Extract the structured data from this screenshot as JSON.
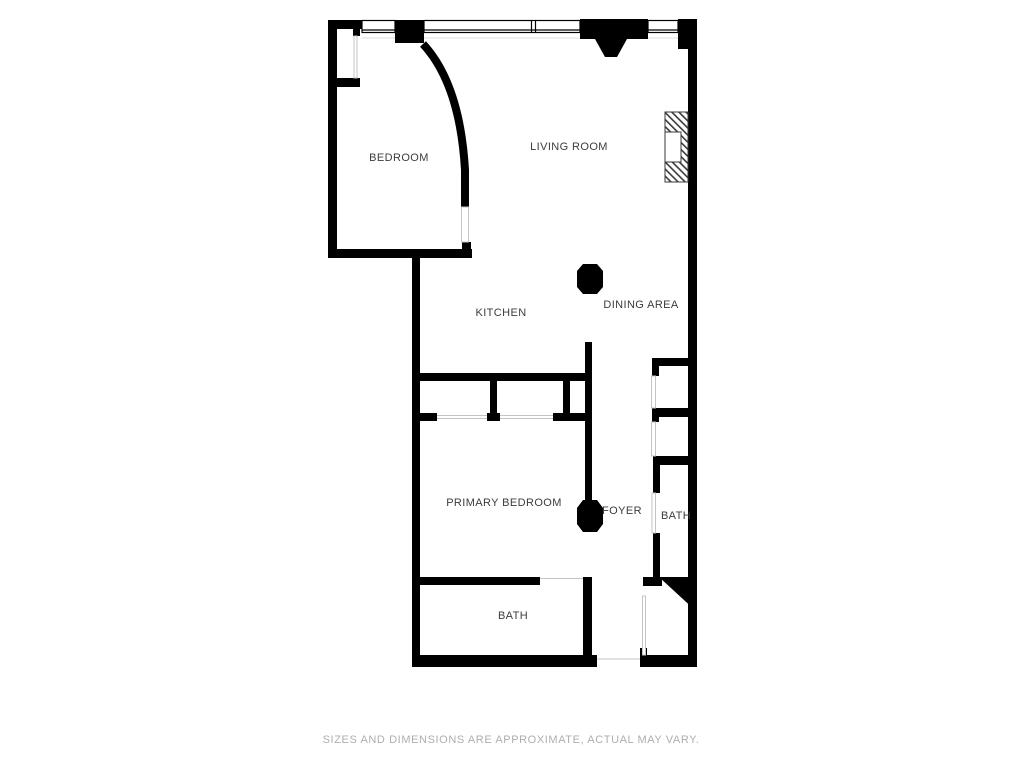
{
  "floor_plan": {
    "labels": {
      "bedroom": "BEDROOM",
      "living_room": "LIVING ROOM",
      "kitchen": "KITCHEN",
      "dining_area": "DINING AREA",
      "primary_bedroom": "PRIMARY BEDROOM",
      "foyer": "FOYER",
      "bath_upper": "BATH",
      "bath_lower": "BATH"
    },
    "disclaimer": "SIZES AND DIMENSIONS ARE APPROXIMATE, ACTUAL MAY VARY.",
    "colors": {
      "wall": "#000000",
      "label_text": "#3c3c3c",
      "disclaimer_text": "#aeaeae",
      "opening_line": "#c4c4c4",
      "background": "#ffffff"
    }
  }
}
